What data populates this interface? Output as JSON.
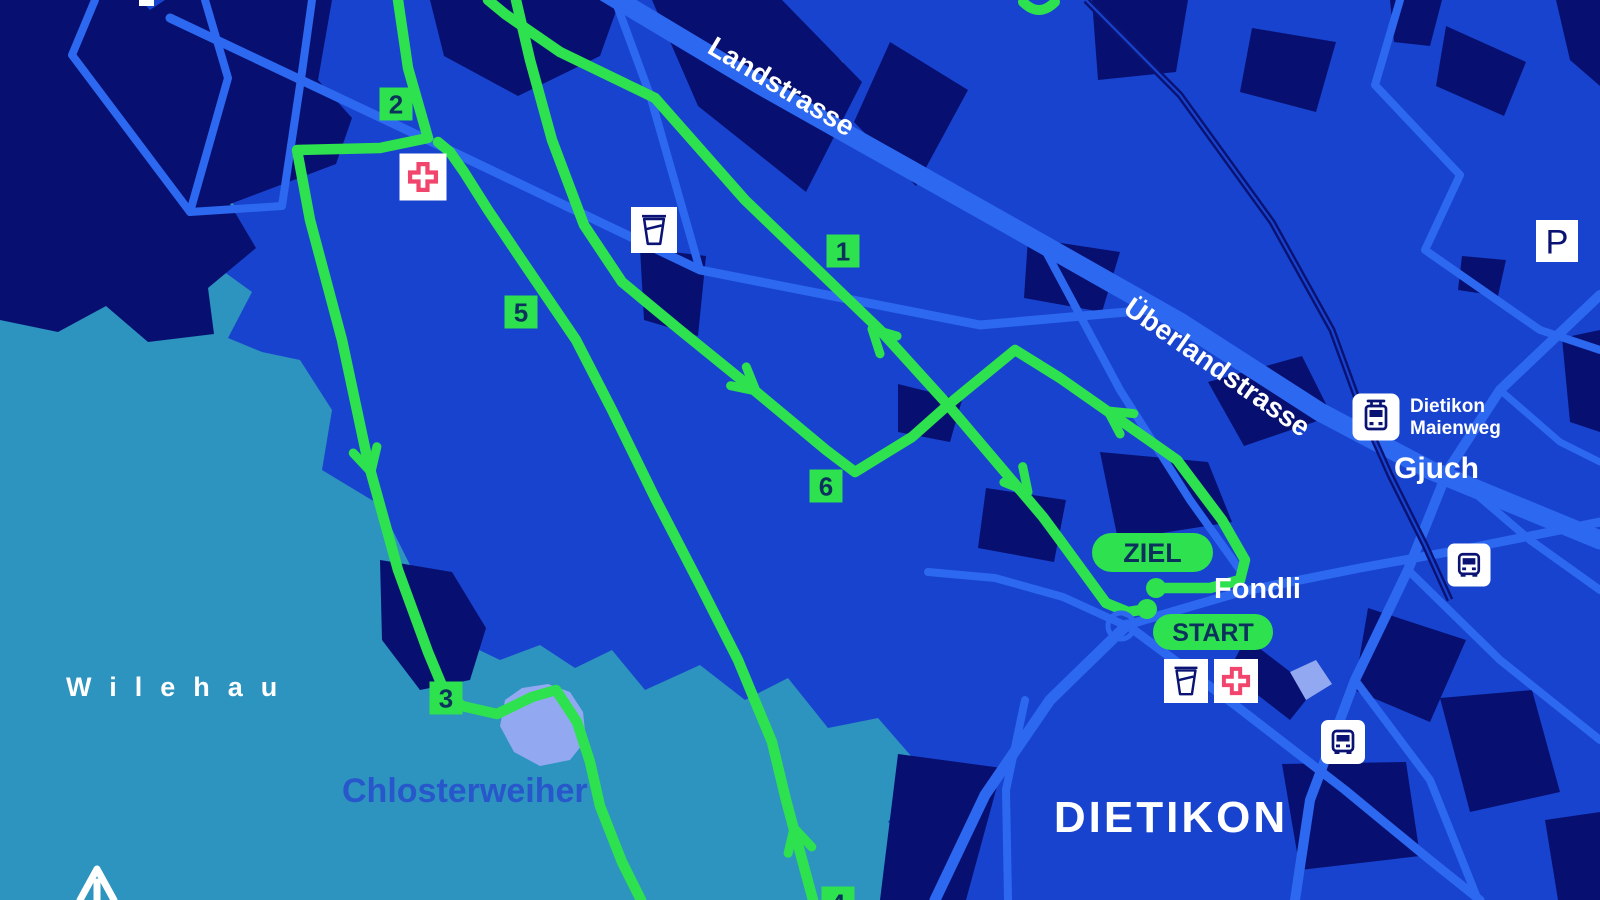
{
  "map": {
    "title": "Dietikon race course map",
    "colors": {
      "background": "#1843ce",
      "forest_teal": "#2d93bf",
      "light_teal": "#5aa3cf",
      "building_navy": "#071070",
      "road_blue": "#2c68f0",
      "route_green": "#2ee14e",
      "badge_text_navy": "#0c315c",
      "water_periwinkle": "#92a9f1",
      "railway_navy": "#0a1373",
      "icon_glyph_navy": "#0a1373",
      "medical_cross_pink": "#f2456d",
      "label_blue": "#2857cc",
      "label_white": "#ffffff"
    },
    "place_labels": [
      {
        "id": "landstrasse",
        "text": "Landstrasse",
        "x": 706,
        "y": 52,
        "size": 28,
        "rotate": 31,
        "color": "#ffffff",
        "weight": 700
      },
      {
        "id": "ueberlandstrasse",
        "text": "Überlandstrasse",
        "x": 1122,
        "y": 312,
        "size": 28,
        "rotate": 35,
        "color": "#ffffff",
        "weight": 700
      },
      {
        "id": "wilehau",
        "text": "Wilehau",
        "x": 66,
        "y": 696,
        "size": 27,
        "ls": 18,
        "color": "#ffffff",
        "weight": 700
      },
      {
        "id": "chlosterweiher",
        "text": "Chlosterweiher",
        "x": 342,
        "y": 802,
        "size": 34,
        "color": "#2857cc",
        "weight": 700
      },
      {
        "id": "gjuch",
        "text": "Gjuch",
        "x": 1394,
        "y": 478,
        "size": 30,
        "color": "#ffffff",
        "weight": 700
      },
      {
        "id": "fondli",
        "text": "Fondli",
        "x": 1214,
        "y": 598,
        "size": 29,
        "color": "#ffffff",
        "weight": 700
      },
      {
        "id": "dietikon",
        "text": "DIETIKON",
        "x": 1171,
        "y": 832,
        "size": 44,
        "ls": 3,
        "color": "#ffffff",
        "weight": 700,
        "anchor": "middle"
      },
      {
        "id": "tram-stop-line1",
        "text": "Dietikon",
        "x": 1410,
        "y": 412,
        "size": 19,
        "color": "#ffffff",
        "weight": 700
      },
      {
        "id": "tram-stop-line2",
        "text": "Maienweg",
        "x": 1410,
        "y": 434,
        "size": 19,
        "color": "#ffffff",
        "weight": 700
      }
    ],
    "route": {
      "ziel_label": "ZIEL",
      "start_label": "START",
      "pills": [
        {
          "id": "ziel",
          "x": 1092,
          "y": 533,
          "w": 121,
          "h": 39,
          "size": 27,
          "bind": "map.route.ziel_label"
        },
        {
          "id": "start",
          "x": 1153,
          "y": 614,
          "w": 120,
          "h": 36,
          "size": 25,
          "bind": "map.route.start_label"
        }
      ],
      "markers": [
        {
          "label": "1",
          "x": 843,
          "y": 251
        },
        {
          "label": "2",
          "x": 396,
          "y": 104
        },
        {
          "label": "3",
          "x": 446,
          "y": 698
        },
        {
          "label": "4",
          "x": 838,
          "y": 903
        },
        {
          "label": "5",
          "x": 521,
          "y": 312
        },
        {
          "label": "6",
          "x": 826,
          "y": 486
        }
      ],
      "dots": [
        {
          "x": 1156,
          "y": 588
        },
        {
          "x": 1147,
          "y": 609
        }
      ],
      "roundabout": {
        "x": 1121,
        "y": 626,
        "r": 13
      },
      "paths": [
        {
          "pts": "1147,609 1128,612 1106,603 1060,540 1043,517 948,405 880,330 745,200 655,98 560,52 505,14 488,0"
        },
        {
          "pts": "398,0 408,68 428,138 380,148 297,150 310,220 342,340 368,462 398,570 428,652 443,688 462,706 497,714 532,697 556,690 577,722 590,762 600,806 622,862 641,900"
        },
        {
          "pts": "813,900 800,852 786,800 772,742 738,660 700,585 656,500 612,410 576,340 523,262 488,210 464,172 450,152 438,142"
        },
        {
          "pts": "516,0 530,60 552,140 584,225 622,282 680,330 754,390 826,450 855,472 912,437 948,405 1015,350 1060,378 1110,413 1177,460 1222,520 1245,560 1240,580 1210,588 1156,588"
        }
      ],
      "arc_paths": [
        {
          "d": "M 1023,2 Q 1039,18 1055,2"
        }
      ],
      "arrows": [
        {
          "x": 872,
          "y": 329,
          "angle": -136
        },
        {
          "x": 1028,
          "y": 492,
          "angle": 50
        },
        {
          "x": 371,
          "y": 472,
          "angle": 75
        },
        {
          "x": 794,
          "y": 828,
          "angle": -105
        },
        {
          "x": 756,
          "y": 391,
          "angle": 40
        },
        {
          "x": 1108,
          "y": 411,
          "angle": -146
        }
      ]
    },
    "icons": [
      {
        "type": "first-aid",
        "x": 423,
        "y": 177,
        "size": 47
      },
      {
        "type": "water-cup",
        "x": 654,
        "y": 230,
        "size": 46
      },
      {
        "type": "water-cup",
        "x": 1186,
        "y": 681,
        "size": 44
      },
      {
        "type": "first-aid",
        "x": 1236,
        "y": 681,
        "size": 44
      },
      {
        "type": "tram-stop",
        "x": 1376,
        "y": 417,
        "size": 47
      },
      {
        "type": "bus-stop",
        "x": 1469,
        "y": 565,
        "size": 43
      },
      {
        "type": "bus-stop",
        "x": 1343,
        "y": 742,
        "size": 44
      },
      {
        "type": "parking",
        "x": 1557,
        "y": 241,
        "size": 42,
        "label": "P"
      }
    ],
    "terrain": {
      "forest": [
        "0,138 60,142 92,150 122,180 168,162 205,168 238,210 205,258 252,292 228,338 262,352 300,360 332,410 322,470 380,505 420,585 448,635 500,660 540,645 575,668 612,650 645,690 700,665 745,700 788,678 828,728 878,718 925,772 888,822 940,872 918,900 0,900"
      ],
      "light_teal": [
        "788,48 820,42 843,62 852,92 838,108 810,100 792,78"
      ],
      "water": [
        "505,700 522,688 548,684 570,692 583,712 586,740 570,760 540,766 514,752 500,726"
      ],
      "accents": [
        "1290,672 1316,660 1332,684 1306,700"
      ],
      "buildings": [
        "0,0 140,0 150,10 165,0 332,0 318,80 352,118 336,164 230,204 256,248 208,288 214,334 148,342 106,306 58,332 0,320",
        "430,0 620,0 600,56 518,96 444,56",
        "652,0 782,0 862,82 806,192 698,106",
        "890,42 968,90 916,186 854,122",
        "1092,0 1188,0 1176,72 1098,80",
        "1390,0 1442,0 1430,46 1394,42",
        "1446,26 1526,62 1504,116 1436,86",
        "1556,0 1600,0 1600,86 1570,60",
        "1252,28 1336,42 1316,112 1240,92",
        "1562,338 1600,330 1600,432 1570,422",
        "1462,256 1506,260 1498,296 1458,290",
        "640,248 706,256 698,336 644,320",
        "1208,382 1302,356 1332,416 1244,446",
        "1028,238 1120,252 1102,312 1024,298",
        "898,384 962,400 950,442 898,432",
        "1100,452 1208,462 1232,522 1118,540",
        "986,488 1066,500 1054,562 978,548",
        "1246,638 1314,690 1290,720 1228,672",
        "1282,764 1406,762 1420,856 1300,870",
        "1440,698 1532,690 1560,792 1470,812",
        "1545,820 1600,812 1600,900 1558,900",
        "1368,608 1466,640 1430,722 1354,690",
        "898,754 1002,768 966,900 880,900",
        "380,560 452,572 486,628 470,680 420,690 382,640"
      ]
    },
    "roads": [
      {
        "pts": "598,-12 760,85 1000,220 1180,322 1320,412 1430,470 1600,540",
        "w": 19
      },
      {
        "pts": "170,18 428,140 700,270 980,325 1150,310",
        "w": 9
      },
      {
        "pts": "615,0 650,95 700,270",
        "w": 8
      },
      {
        "pts": "1045,250 1120,390 1190,500 1240,570",
        "w": 8
      },
      {
        "pts": "1127,625 1240,592 1360,568 1470,548 1600,522",
        "w": 9
      },
      {
        "pts": "1127,625 1050,700 985,795 935,900",
        "w": 11
      },
      {
        "pts": "1127,625 1235,705 1345,790 1430,860 1480,900",
        "w": 9
      },
      {
        "pts": "1025,700 1006,790 1008,900",
        "w": 8
      },
      {
        "pts": "1600,295 1500,390 1448,470 1408,570 1355,680 1310,800 1295,900",
        "w": 10
      },
      {
        "pts": "1448,470 1530,540 1600,590",
        "w": 8
      },
      {
        "pts": "1408,570 1500,660 1600,740",
        "w": 8
      },
      {
        "pts": "1355,680 1430,780 1478,900",
        "w": 8
      },
      {
        "pts": "1500,390 1560,442 1600,462",
        "w": 7
      },
      {
        "pts": "1400,0 1375,85 1460,175 1425,250 1540,330 1600,350",
        "w": 8
      },
      {
        "pts": "95,0 72,55 190,212 282,206 302,72 312,0",
        "w": 8
      },
      {
        "pts": "205,0 228,78 190,212",
        "w": 8
      },
      {
        "pts": "1122,624 1063,597 995,578 928,572",
        "w": 8
      }
    ],
    "railway": {
      "pts": "1086,0 1180,95 1272,222 1332,330 1362,412 1390,475 1425,545 1450,600"
    }
  }
}
